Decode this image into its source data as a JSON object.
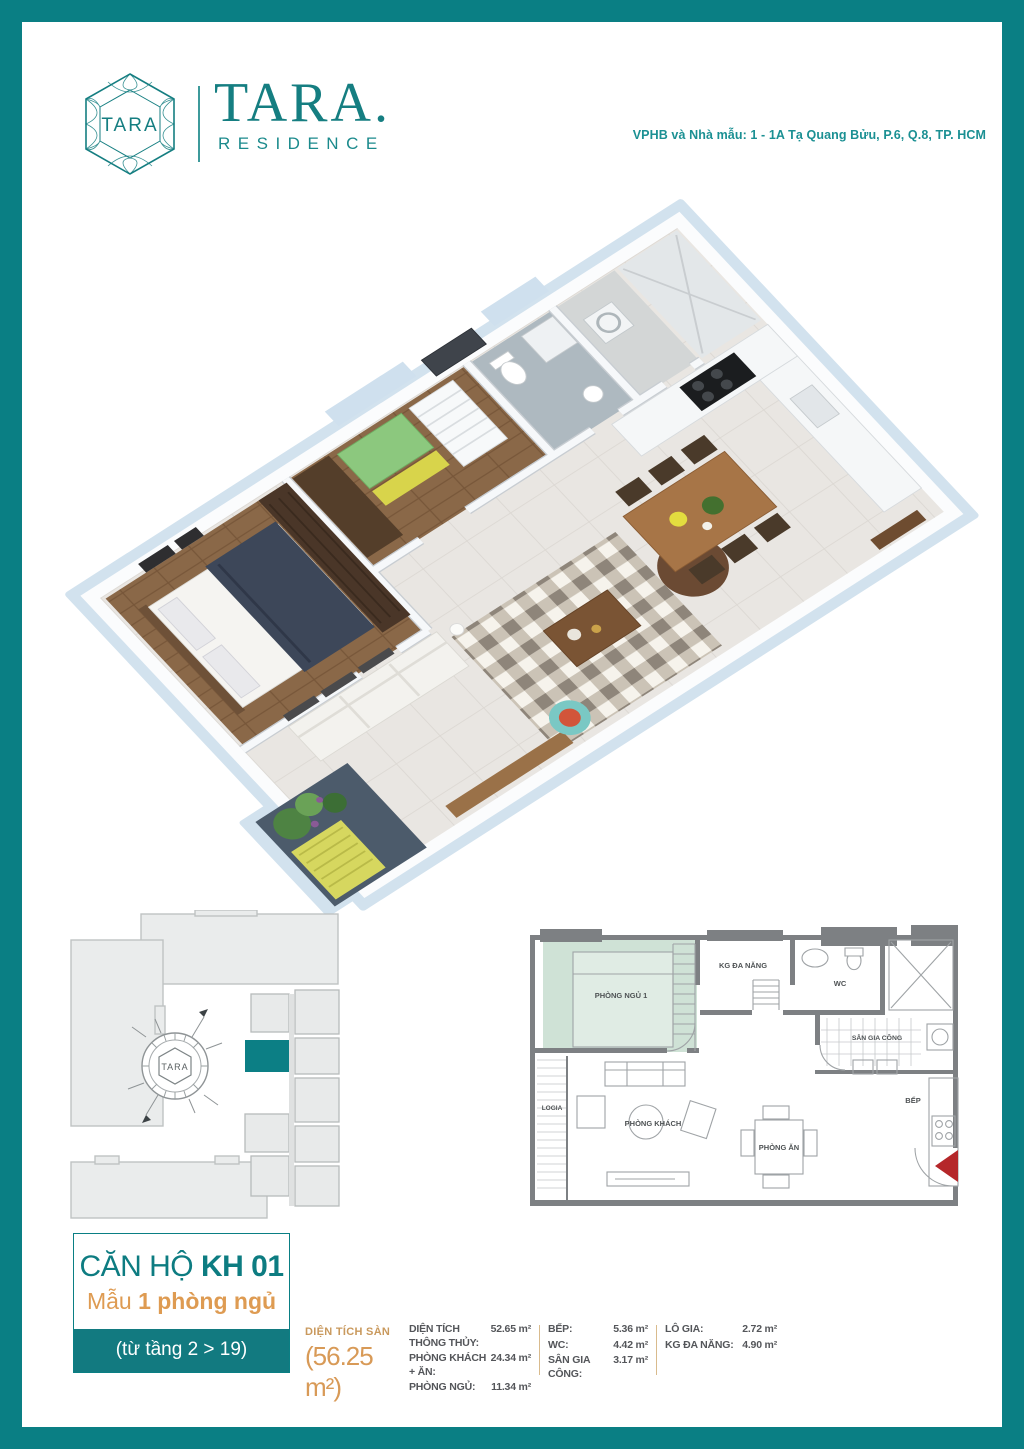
{
  "brand": {
    "emblem_text": "TARA",
    "wordmark": "TARA.",
    "wordmark_sub": "RESIDENCE",
    "address": "VPHB và Nhà mẫu: 1 - 1A Tạ Quang Bửu, P.6, Q.8, TP. HCM"
  },
  "colors": {
    "frame_teal": "#0a7f84",
    "text_teal": "#1b9093",
    "orange": "#de9b52",
    "tan": "#c9995d",
    "wall_gray": "#7d8083",
    "bedroom_green": "#cfe2d6",
    "unit_highlight": "#0c7f85",
    "entry_red": "#b5272a"
  },
  "unit_card": {
    "title_prefix": "CĂN HỘ ",
    "title_code": "KH 01",
    "subtitle_prefix": "Mẫu ",
    "subtitle_bold": "1 phòng ngủ",
    "floor_range": "(từ tầng 2 > 19)"
  },
  "areas": {
    "gross": {
      "label": "DIỆN TÍCH SÀN",
      "value": "(56.25 m²)"
    },
    "col_a": [
      {
        "label": "DIỆN TÍCH THÔNG THỦY:",
        "value": "52.65 m²"
      },
      {
        "label": "PHÒNG KHÁCH + ĂN:",
        "value": "24.34 m²"
      },
      {
        "label": "PHÒNG NGỦ:",
        "value": "11.34 m²"
      }
    ],
    "col_b": [
      {
        "label": "BẾP:",
        "value": "5.36 m²"
      },
      {
        "label": "WC:",
        "value": "4.42 m²"
      },
      {
        "label": "SÂN GIA CÔNG:",
        "value": "3.17 m²"
      }
    ],
    "col_c": [
      {
        "label": "LÔ GIA:",
        "value": "2.72 m²"
      },
      {
        "label": "KG ĐA NĂNG:",
        "value": "4.90 m²"
      }
    ]
  },
  "floorplan_2d": {
    "rooms": {
      "bedroom": "PHÒNG NGỦ 1",
      "multi": "KG ĐA NĂNG",
      "wc": "WC",
      "service": "SÂN GIA CÔNG",
      "logia": "LOGIA",
      "living": "PHÒNG KHÁCH",
      "dining": "PHÒNG ĂN",
      "kitchen": "BẾP"
    }
  },
  "site_plan": {
    "compass_label": "TARA"
  }
}
